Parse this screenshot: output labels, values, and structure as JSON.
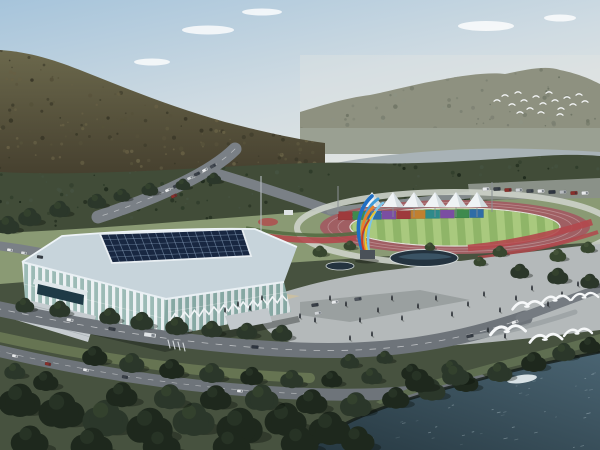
{
  "meta": {
    "description": "Aerial architectural rendering of a riverside sports complex: white lattice arena with dark glass roof, running track with striped infield, white peaked tent canopies over a rainbow panel wall, a blue-and-orange feather sculpture, plaza with pond and people, forested mountains, a river, and white egrets flying over trees beside dark teal water."
  },
  "colors": {
    "sky_top": "#a6c4db",
    "sky_mid": "#cfdbe2",
    "sky_low": "#e6e7e1",
    "cloud": "#ffffff",
    "ridge_right": "#8e9180",
    "hill_top": "#6b684c",
    "hill_bottom": "#453f2e",
    "haze_band": "#9aa092",
    "river": "#a8b2b6",
    "forest_band": "#414c38",
    "lawn": "#8a9a74",
    "underlayer": "#47523f",
    "parking": "#8a9188",
    "road": "#7a8086",
    "road_front": "#6e747a",
    "track": "#a05f63",
    "track_ring": "#ccd1c9",
    "lane_line": "#b98a8d",
    "field_light": "#a9c97e",
    "field_dark": "#8fb568",
    "flower_red": "#b2484c",
    "hedge_green": "#546b42",
    "plaza": "#b4b9ba",
    "plaza_tan": "#c9bfa4",
    "lot": "#9aa0a0",
    "pond": "#24333f",
    "pond_inner": "#3d5668",
    "roof_band": "#c7d4db",
    "roof_glass": "#182741",
    "roof_grid": "#8fa7c2",
    "wall_white": "#eaf0f2",
    "wall_glass": "#8fb2ac",
    "stair": "#c6ccd0",
    "entrance_glass": "#1f3a46",
    "shore_grass": "#5f6e51",
    "water_light": "#4a6472",
    "water_dark": "#273942",
    "bank_dark": "#141c18",
    "bird_white": "#f6f8f9",
    "tent_white": "#eff3f5",
    "tent_shade": "#ccd6da",
    "pole_gray": "#8a9094"
  },
  "scene": {
    "clouds": [
      [
        208,
        30,
        26,
        4.5
      ],
      [
        152,
        62,
        18,
        3.5
      ],
      [
        262,
        12,
        20,
        3.5
      ],
      [
        486,
        26,
        28,
        5
      ],
      [
        560,
        18,
        16,
        3.5
      ]
    ],
    "panels": [
      "#9e3a3c",
      "#3f8a4e",
      "#2e6ca6",
      "#7b4ea2",
      "#9e3a3c",
      "#c08030",
      "#2f8a8a",
      "#7b4ea2",
      "#3f8a4e",
      "#2e6ca6"
    ],
    "tents": {
      "xs": [
        372,
        393,
        414,
        435,
        456,
        477
      ],
      "peak_y": 192,
      "base_y": 207,
      "half_w": 11
    },
    "sculpture": {
      "pedestal": "#4a5158",
      "plumes": [
        {
          "d": "M363,252 C355,230 357,210 372,196",
          "c": "#1f6fc4",
          "w": 3.6
        },
        {
          "d": "M366,252 C360,228 364,208 378,199",
          "c": "#3f9bd8",
          "w": 3.0
        },
        {
          "d": "M369,252 C366,230 371,212 383,203",
          "c": "#7cc4e8",
          "w": 2.4
        },
        {
          "d": "M365,251 C359,234 362,218 373,207",
          "c": "#e8822c",
          "w": 2.8
        },
        {
          "d": "M367,250 C363,236 366,222 375,212",
          "c": "#ecc62e",
          "w": 2.0
        },
        {
          "d": "M364,251 C360,240 362,230 369,220",
          "c": "#c23b2a",
          "w": 1.8
        }
      ]
    },
    "tree_palette": [
      "#1e281d",
      "#2b372a",
      "#37462f",
      "#49573c"
    ],
    "trees_mid": [
      [
        320,
        252,
        7,
        2
      ],
      [
        350,
        246,
        6,
        2
      ],
      [
        430,
        247,
        5,
        2
      ],
      [
        500,
        252,
        7,
        2
      ],
      [
        558,
        256,
        8,
        2
      ],
      [
        588,
        248,
        7,
        2
      ],
      [
        520,
        272,
        9,
        1
      ],
      [
        558,
        277,
        10,
        1
      ],
      [
        590,
        282,
        9,
        1
      ],
      [
        480,
        262,
        6,
        2
      ],
      [
        97,
        202,
        9,
        1
      ],
      [
        122,
        196,
        8,
        1
      ],
      [
        150,
        190,
        8,
        1
      ],
      [
        183,
        185,
        7,
        1
      ],
      [
        214,
        179,
        7,
        1
      ],
      [
        60,
        210,
        10,
        1
      ],
      [
        30,
        218,
        11,
        1
      ],
      [
        8,
        226,
        11,
        1
      ],
      [
        25,
        306,
        9,
        1
      ],
      [
        60,
        310,
        10,
        1
      ],
      [
        110,
        317,
        10,
        1
      ],
      [
        142,
        322,
        11,
        1
      ],
      [
        177,
        327,
        11,
        1
      ],
      [
        212,
        330,
        10,
        1
      ],
      [
        247,
        332,
        10,
        1
      ],
      [
        282,
        334,
        10,
        1
      ]
    ],
    "trees_front": [
      [
        95,
        357,
        12,
        0
      ],
      [
        132,
        364,
        12,
        1
      ],
      [
        172,
        370,
        12,
        0
      ],
      [
        212,
        374,
        12,
        1
      ],
      [
        252,
        377,
        11,
        0
      ],
      [
        292,
        380,
        11,
        1
      ],
      [
        332,
        380,
        10,
        0
      ],
      [
        372,
        377,
        10,
        1
      ],
      [
        412,
        373,
        10,
        0
      ],
      [
        452,
        369,
        10,
        1
      ],
      [
        15,
        372,
        10,
        1
      ],
      [
        46,
        382,
        12,
        0
      ],
      [
        20,
        402,
        20,
        0
      ],
      [
        62,
        412,
        22,
        0
      ],
      [
        106,
        420,
        22,
        1
      ],
      [
        150,
        428,
        22,
        0
      ],
      [
        194,
        421,
        20,
        1
      ],
      [
        240,
        428,
        22,
        0
      ],
      [
        286,
        421,
        20,
        0
      ],
      [
        330,
        430,
        20,
        0
      ],
      [
        30,
        442,
        18,
        0
      ],
      [
        92,
        446,
        20,
        0
      ],
      [
        162,
        446,
        18,
        0
      ],
      [
        232,
        446,
        18,
        0
      ],
      [
        300,
        443,
        18,
        0
      ],
      [
        358,
        441,
        16,
        0
      ],
      [
        262,
        399,
        16,
        1
      ],
      [
        216,
        399,
        15,
        0
      ],
      [
        170,
        398,
        15,
        1
      ],
      [
        122,
        396,
        15,
        0
      ],
      [
        312,
        403,
        15,
        0
      ],
      [
        356,
        406,
        15,
        1
      ],
      [
        396,
        399,
        13,
        0
      ],
      [
        432,
        391,
        13,
        1
      ],
      [
        466,
        383,
        12,
        0
      ],
      [
        500,
        373,
        12,
        1
      ],
      [
        534,
        363,
        12,
        0
      ],
      [
        564,
        353,
        11,
        1
      ],
      [
        590,
        346,
        10,
        0
      ],
      [
        420,
        382,
        14,
        0
      ],
      [
        456,
        376,
        13,
        1
      ],
      [
        350,
        362,
        9,
        1
      ],
      [
        385,
        358,
        8,
        1
      ]
    ],
    "cars": [
      [
        486,
        189,
        -3,
        "#e8eaec",
        7,
        3.5
      ],
      [
        497,
        189,
        -3,
        "#3a4048",
        7,
        3.5
      ],
      [
        508,
        190,
        -3,
        "#8a2f2a",
        7,
        3.5
      ],
      [
        519,
        190,
        -3,
        "#cfd3d6",
        7,
        3.5
      ],
      [
        530,
        191,
        -3,
        "#444a52",
        7,
        3.5
      ],
      [
        541,
        191,
        -3,
        "#e8eaec",
        7,
        3.5
      ],
      [
        552,
        192,
        -3,
        "#2f3640",
        7,
        3.5
      ],
      [
        563,
        192,
        -3,
        "#b8bcc0",
        7,
        3.5
      ],
      [
        574,
        193,
        -3,
        "#8a2f2a",
        7,
        3.5
      ],
      [
        585,
        193,
        -3,
        "#e8eaec",
        7,
        3.5
      ],
      [
        168,
        190,
        -25,
        "#e8eaec",
        6,
        3
      ],
      [
        176,
        186,
        -25,
        "#3a4048",
        6,
        3
      ],
      [
        184,
        182,
        -25,
        "#e8eaec",
        6,
        3
      ],
      [
        174,
        196,
        -25,
        "#8a2f2a",
        6,
        3
      ],
      [
        190,
        178,
        -25,
        "#cfd3d6",
        6,
        3
      ],
      [
        197,
        174,
        -25,
        "#3a4048",
        6,
        3
      ],
      [
        205,
        170,
        -28,
        "#e8eaec",
        6,
        3
      ],
      [
        213,
        166,
        -28,
        "#454b53",
        6,
        3
      ],
      [
        10,
        250,
        8,
        "#e8eaec",
        6,
        3
      ],
      [
        24,
        253,
        8,
        "#d8dadc",
        6,
        3
      ],
      [
        40,
        257,
        8,
        "#3a4048",
        6,
        3
      ],
      [
        70,
        320,
        10,
        "#e8eaec",
        7,
        3.2
      ],
      [
        112,
        329,
        10,
        "#3a4048",
        7,
        3.2
      ],
      [
        150,
        335,
        8,
        "#dfe3e6",
        12,
        4.2
      ],
      [
        255,
        347,
        4,
        "#2f3640",
        7,
        3.2
      ],
      [
        470,
        336,
        -12,
        "#3a4048",
        7,
        3.2
      ],
      [
        515,
        322,
        -18,
        "#e8eaec",
        7,
        3.2
      ],
      [
        15,
        356,
        12,
        "#e8eaec",
        6,
        3
      ],
      [
        48,
        364,
        12,
        "#8a2f2a",
        6,
        3
      ],
      [
        86,
        370,
        12,
        "#e8eaec",
        6,
        3
      ],
      [
        125,
        377,
        10,
        "#3a4048",
        6,
        3
      ],
      [
        240,
        391,
        4,
        "#e8eaec",
        6,
        3
      ],
      [
        315,
        305,
        -8,
        "#3a4048",
        7,
        3.2
      ],
      [
        335,
        302,
        -8,
        "#e8eaec",
        7,
        3.2
      ],
      [
        358,
        299,
        -8,
        "#50565e",
        7,
        3.2
      ],
      [
        318,
        313,
        -8,
        "#cfd3d6",
        7,
        3.2
      ]
    ],
    "people": [
      [
        300,
        318
      ],
      [
        315,
        322
      ],
      [
        330,
        300
      ],
      [
        346,
        306
      ],
      [
        360,
        322
      ],
      [
        378,
        312
      ],
      [
        392,
        300
      ],
      [
        402,
        320
      ],
      [
        418,
        308
      ],
      [
        436,
        300
      ],
      [
        452,
        316
      ],
      [
        468,
        306
      ],
      [
        484,
        296
      ],
      [
        500,
        312
      ],
      [
        516,
        300
      ],
      [
        532,
        290
      ],
      [
        548,
        306
      ],
      [
        562,
        296
      ],
      [
        578,
        286
      ],
      [
        238,
        306
      ],
      [
        250,
        310
      ],
      [
        262,
        300
      ],
      [
        225,
        312
      ],
      [
        488,
        332
      ],
      [
        505,
        338
      ],
      [
        372,
        336
      ],
      [
        350,
        340
      ]
    ],
    "flock": [
      [
        497,
        100
      ],
      [
        505,
        95
      ],
      [
        512,
        104
      ],
      [
        518,
        92
      ],
      [
        524,
        100
      ],
      [
        530,
        108
      ],
      [
        536,
        96
      ],
      [
        543,
        103
      ],
      [
        549,
        92
      ],
      [
        555,
        100
      ],
      [
        561,
        108
      ],
      [
        567,
        97
      ],
      [
        573,
        104
      ],
      [
        579,
        94
      ],
      [
        585,
        101
      ],
      [
        520,
        112
      ],
      [
        541,
        112
      ],
      [
        560,
        114
      ]
    ],
    "gulls": [
      [
        528,
        306,
        1.1
      ],
      [
        556,
        300,
        1.0
      ],
      [
        585,
        297,
        0.95
      ],
      [
        508,
        331,
        1.25
      ],
      [
        546,
        339,
        1.15
      ],
      [
        578,
        333,
        1.0
      ]
    ],
    "texture": {
      "hill_dots": 260,
      "ridge_dots": 90,
      "band_dots": 200,
      "ripples": 85
    }
  }
}
